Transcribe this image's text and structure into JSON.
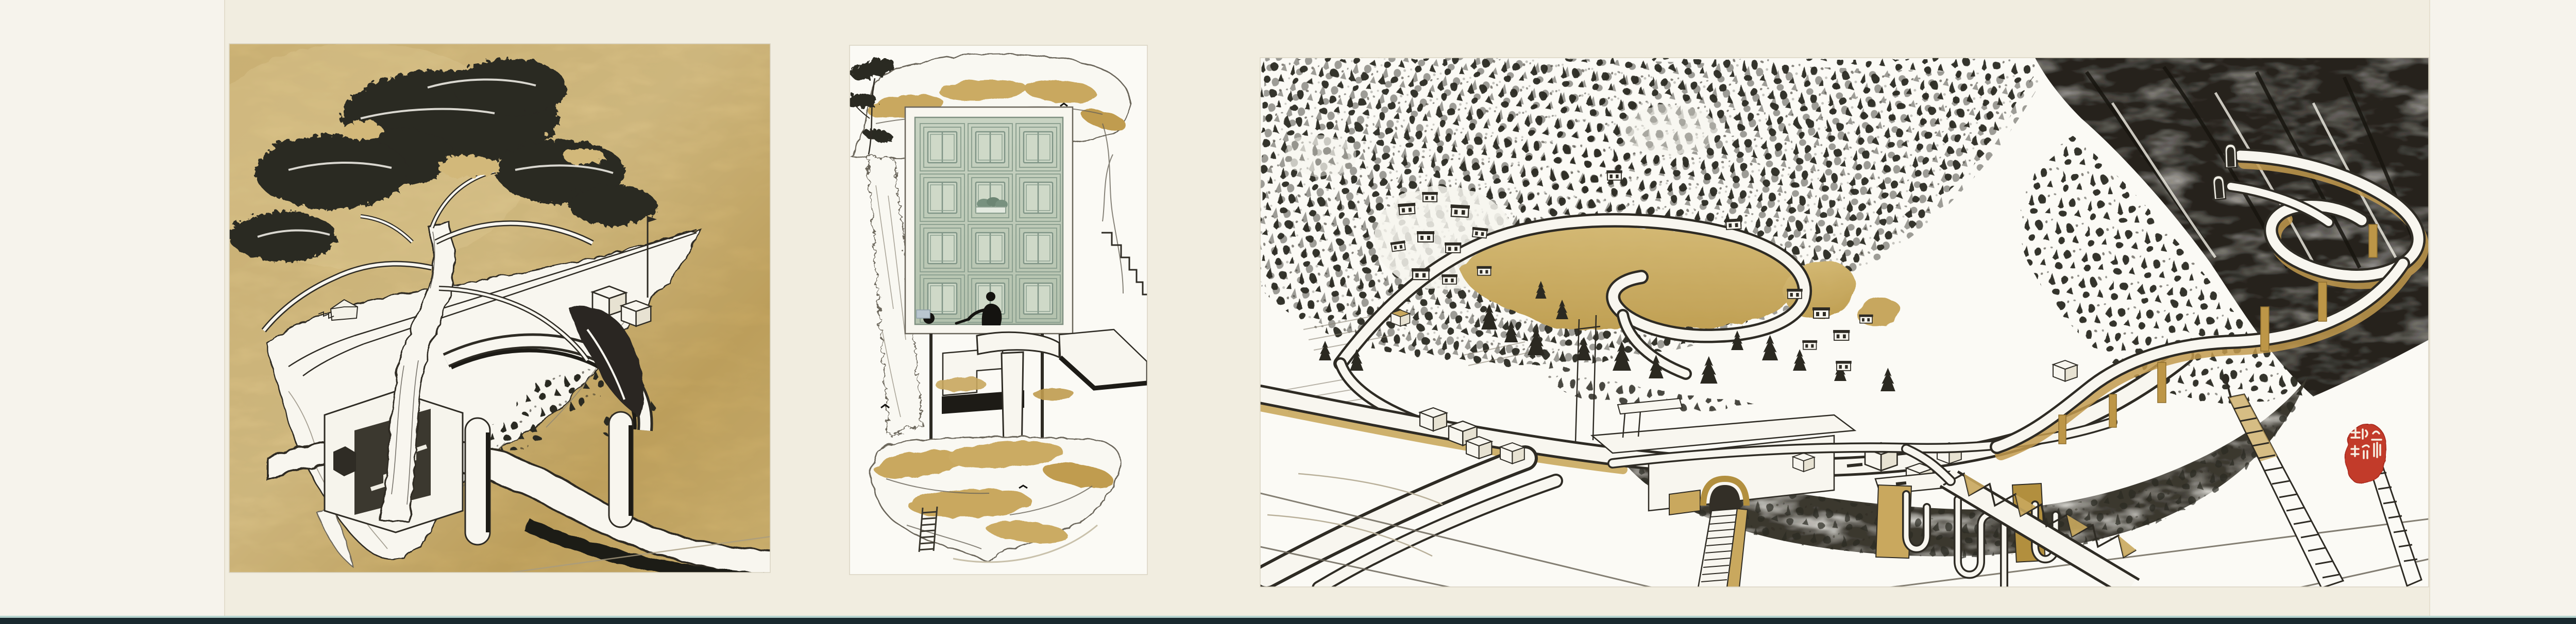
{
  "artwork": {
    "kind": "three-panel handscroll drawing, ink and gold on paper",
    "panels": [
      {
        "name": "pine-cliff-panel",
        "description": "Gold ground panel: a gnarled pine grows from a floating cliff that is pierced by a white elevated road sweeping off to the right over a black shadow"
      },
      {
        "name": "facade-rock-panel",
        "description": "White panel: a floating rock slab holds a pale-green coffered facade of twelve recessed window panels with a window box, a tiny seated figure, stilt legs, a drip-shaped pier and a rope ladder hanging below"
      },
      {
        "name": "mountain-village-panel",
        "description": "White panel: bird's-eye ink landscape of a mountain village - stippled forest, flat-roofed houses, a gold meadow ringed by a looping road, a highway interchange with tunnel portals and gold piers, an arched tunnel with long stairways, hanging pipes, a truss bridge and a red artist seal"
      }
    ],
    "seal": {
      "characters": "琼瑜",
      "style": "vermilion relief seal, stylized seal script"
    }
  },
  "colors": {
    "paper": "#f1ede0",
    "paper-light": "#f6f3ec",
    "panel-white": "#fbfaf5",
    "gold-ground": "#d2b87a",
    "gold-ground-deep": "#c3a45f",
    "ink": "#2e2b24",
    "ink-soft": "#6a655a",
    "tree": "#2b2921",
    "paint-white": "#f8f6ef",
    "gold": "#c9a85e",
    "gold-deep": "#b28f3e",
    "facade": "#c3cfbc",
    "facade-line": "#8ca090",
    "facade-line2": "#7f9486",
    "facade-pane": "#cfd9c8",
    "charcoal": "#34312a",
    "shadow-black": "#1d1b16",
    "seal-red": "#c23a29",
    "border-teal": "#b7d4d0",
    "border-dark": "#19292e",
    "figure-black": "#141310"
  }
}
